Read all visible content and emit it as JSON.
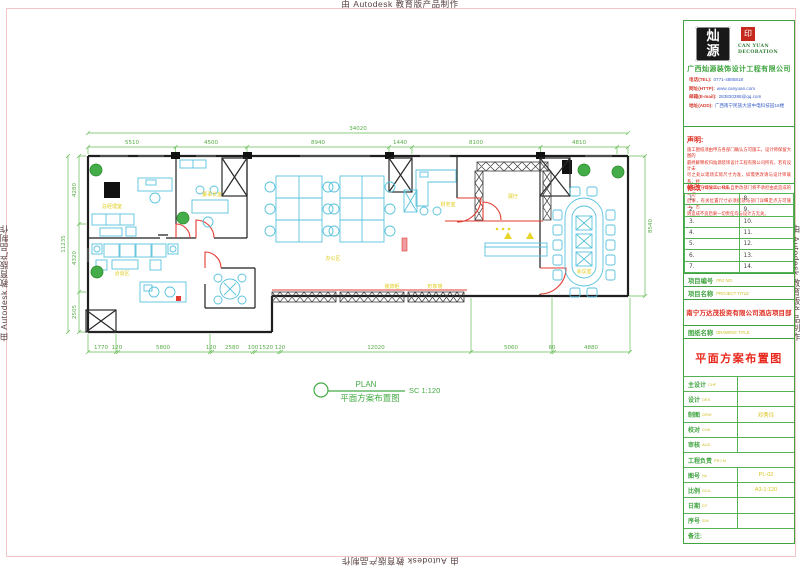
{
  "watermark": {
    "text": "由 Autodesk 教育版产品制作"
  },
  "title_block": {
    "logo": {
      "stamp_char_top": "灿",
      "stamp_char_bottom": "源",
      "seal_char": "印",
      "brand_line1": "CAN YUAN",
      "brand_line2": "DECORATION",
      "company": "广西灿源装饰设计工程有限公司",
      "contacts": [
        {
          "label": "电话(TEL):",
          "value": "0771-4885818"
        },
        {
          "label": "网址(HTTP):",
          "value": "www.canyuan.com"
        },
        {
          "label": "邮箱(E-mail):",
          "value": "283830388@qq.com"
        },
        {
          "label": "地址(ADD):",
          "value": "广西南宁民族大道中电科技园16楼"
        }
      ]
    },
    "statement": {
      "label": "声明:",
      "lines": [
        "施工图纸须由甲方各部门确认方可施工，设计师保留大图的",
        "最终解释权归灿源装饰设计工程有限公司所有，若有设计未",
        "尽之处以现场实际尺寸为准，如需更改请与设计师联系，经",
        "确认后方可施工，凡私自更改部门将不承担由此造成的一切",
        "后果，有关位置尺寸必须提前与部门详细定点方可施工，否",
        "则造成不良后果一切责任均与设计方无关。"
      ]
    },
    "revisions": {
      "label_cn": "修改",
      "label_en": "REVISIONS",
      "rows": [
        {
          "left": "1.",
          "right": "8."
        },
        {
          "left": "2.",
          "right": "9."
        },
        {
          "left": "3.",
          "right": "10."
        },
        {
          "left": "4.",
          "right": "11."
        },
        {
          "left": "5.",
          "right": "12."
        },
        {
          "left": "6.",
          "right": "13."
        },
        {
          "left": "7.",
          "right": "14."
        }
      ]
    },
    "project_no": {
      "label_cn": "项目编号",
      "label_en": "PRJ NO.",
      "value": ""
    },
    "project": {
      "label_cn": "项目名称",
      "label_en": "PROJECT TITLE",
      "value": "南宁万达茂投资有限公司酒店项目部"
    },
    "drawing": {
      "label_cn": "图纸名称",
      "label_en": "DRAWING TITLE",
      "value": "平面方案布置图"
    },
    "fields": [
      {
        "cn": "主设计",
        "en": "CHF",
        "value": ""
      },
      {
        "cn": "设计",
        "en": "DES",
        "value": ""
      },
      {
        "cn": "制图",
        "en": "DRW",
        "value": "邓秀玲"
      },
      {
        "cn": "校对",
        "en": "CHK",
        "value": ""
      },
      {
        "cn": "审核",
        "en": "AUD",
        "value": ""
      },
      {
        "cn": "工程负责",
        "en": "PRJ M",
        "value": ""
      },
      {
        "cn": "图号",
        "en": "No",
        "value": "PL-02"
      },
      {
        "cn": "比例",
        "en": "SCA",
        "value": "A3-1:120"
      },
      {
        "cn": "日期",
        "en": "DT",
        "value": ""
      },
      {
        "cn": "序号",
        "en": "S/N",
        "value": ""
      },
      {
        "cn": "备注:",
        "en": "",
        "value": ""
      }
    ]
  },
  "plan": {
    "callout": {
      "en": "PLAN",
      "cn": "平面方案布置图",
      "scale": "SC 1:120"
    },
    "dims_top": {
      "overall": "34020",
      "segments": [
        "5510",
        "4500",
        "8940",
        "1440",
        "8100",
        "4810"
      ]
    },
    "dims_left": {
      "overall": "11235",
      "segments": [
        "4280",
        "4320",
        "2505"
      ]
    },
    "dims_bottom": [
      "1770",
      "120",
      "5800",
      "120",
      "2580",
      "100",
      "1520",
      "120",
      "12020",
      "5060",
      "60",
      "4880"
    ],
    "dim_right": "8540",
    "labels": {
      "gm_office": "总经理室",
      "chairman_office": "董事长室",
      "open_office": "办公区",
      "finance": "财务室",
      "showroom": "展厅",
      "lounge": "洽谈区",
      "deco_cabinet": "装饰柜",
      "feature_wall": "形象墙",
      "meeting": "会议室"
    }
  }
}
